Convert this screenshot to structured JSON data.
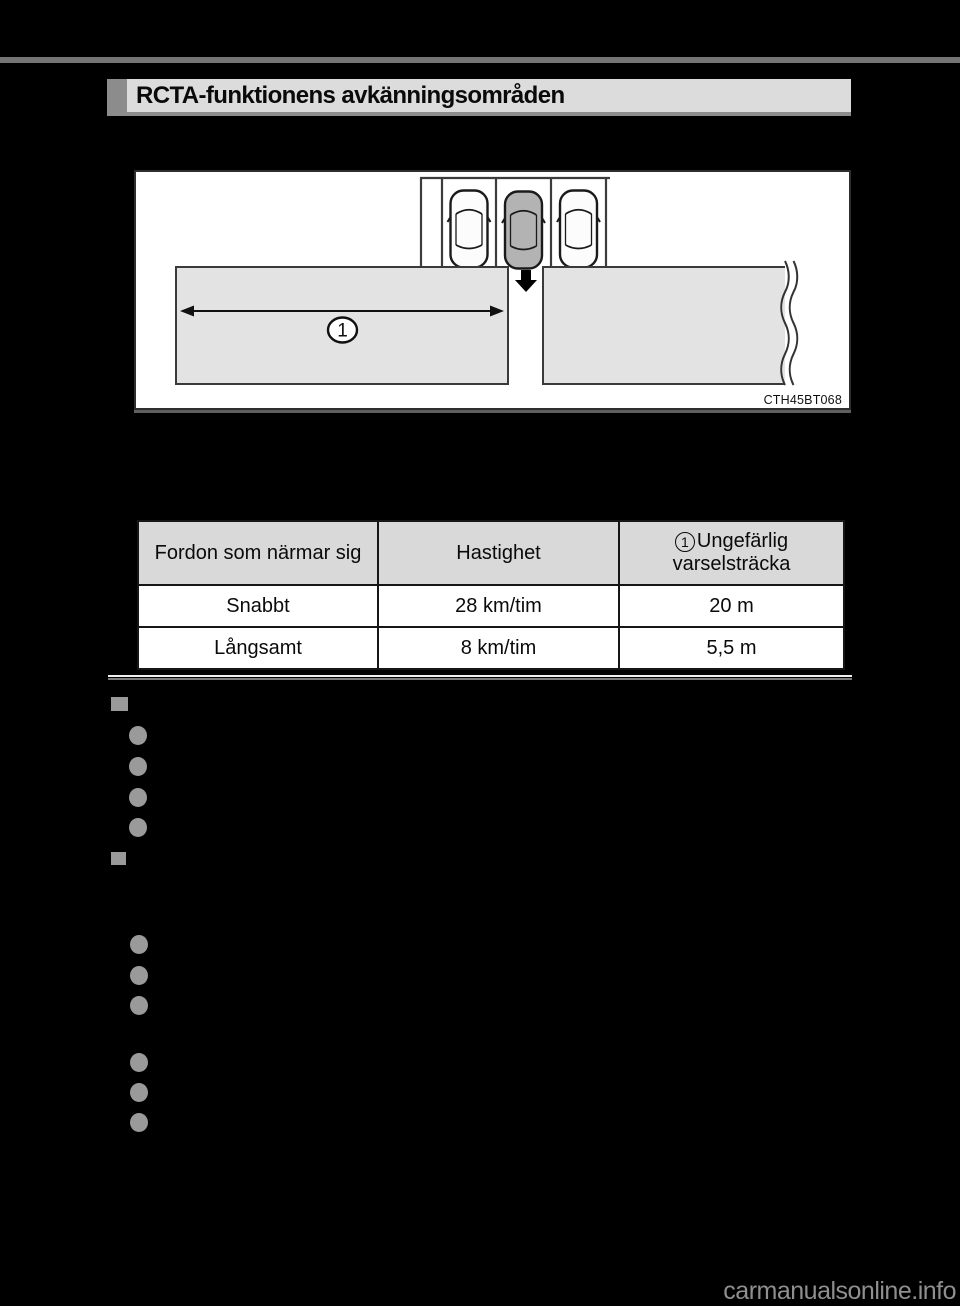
{
  "page": {
    "section_title": "RCTA-funktionens avkänningsområden",
    "watermark": "carmanualsonline.info"
  },
  "diagram": {
    "figure_code": "CTH45BT068",
    "callout_label": "1"
  },
  "table": {
    "header": {
      "col1": "Fordon som närmar sig",
      "col2": "Hastighet",
      "col3_callout": "1",
      "col3_line1": "Ungefärlig",
      "col3_line2": "varselsträcka"
    },
    "rows": [
      {
        "vehicle": "Snabbt",
        "speed": "28 km/tim",
        "distance": "20 m"
      },
      {
        "vehicle": "Långsamt",
        "speed": "8 km/tim",
        "distance": "5,5 m"
      }
    ]
  },
  "colors": {
    "page_background": "#000000",
    "top_rule": "#757575",
    "title_bar_background": "#dcdcdc",
    "title_bar_accent": "#8c8c8c",
    "table_header_background": "#d9d9d9",
    "detection_area_fill": "#e3e3e3",
    "host_vehicle_fill": "#b3b3b3",
    "bullet_gray": "#9a9a9a"
  }
}
